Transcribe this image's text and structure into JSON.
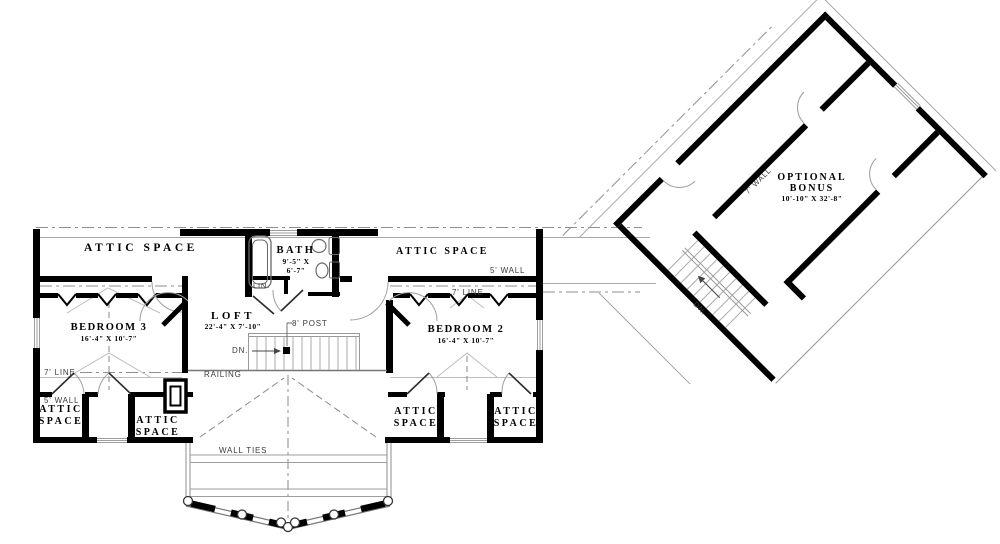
{
  "plan": {
    "rooms": {
      "attic_inline": "ATTIC SPACE",
      "attic_line1": "ATTIC",
      "attic_line2": "SPACE",
      "bath": {
        "name": "BATH",
        "dim1": "9'-5\" X",
        "dim2": "6'-7\""
      },
      "bedroom3": {
        "name": "BEDROOM 3",
        "dims": "16'-4\" X 10'-7\""
      },
      "bedroom2": {
        "name": "BEDROOM 2",
        "dims": "16'-4\" X 10'-7\""
      },
      "loft": {
        "name": "LOFT",
        "dims": "22'-4\" X 7'-10\""
      },
      "bonus": {
        "line1": "OPTIONAL",
        "line2": "BONUS",
        "dims": "10'-10\" X 32'-8\""
      },
      "linen": "LIN."
    },
    "annotations": {
      "wall5": "5' WALL",
      "line7": "7' LINE",
      "wall7": "7' WALL",
      "railing": "RAILING",
      "wall_ties": "WALL TIES",
      "post": "8' POST",
      "down": "DN."
    },
    "colors": {
      "wall": "#000000",
      "thin_line": "#9e9e9e",
      "text": "#1a1a1a"
    }
  }
}
